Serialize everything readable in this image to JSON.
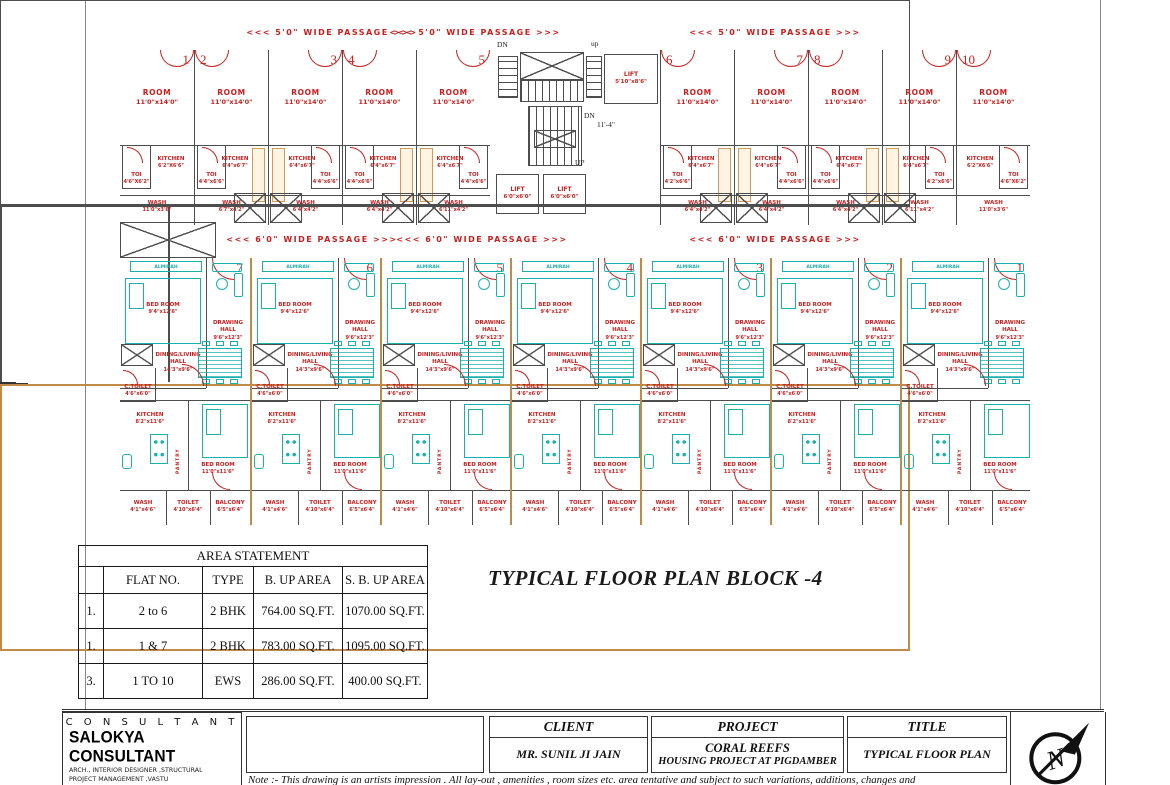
{
  "colors": {
    "red": "#c9201f",
    "teal": "#19b1ae",
    "wall": "#4d4d4d",
    "tan": "#d79a55",
    "tan_fill": "#fdf4e4",
    "black": "#1a1a1a"
  },
  "plan": {
    "passage_top_label": "<<< 5'0\" WIDE PASSAGE >>>",
    "passage_mid_label": "<<< 6'0\" WIDE PASSAGE >>>",
    "core": {
      "dn": "DN",
      "up_lower": "up",
      "up": "UP",
      "dim": "11'-4\"",
      "lift": "LIFT",
      "lift_top_dim": "5'10\"x8'6\"",
      "lift_dim": "6'0\"x6'0\""
    },
    "ews": {
      "room": "ROOM",
      "room_dim": "11'0\"x14'0\"",
      "kitchen": "KITCHEN",
      "kitchen_dim": "6'4\"x6'7\"",
      "kitchen_dim_end": "6'2\"X6'6\"",
      "toi": "TOI",
      "wash": "WASH",
      "units": [
        {
          "num": "1",
          "side": "R",
          "end": true,
          "toi_dim": "4'6\"X6'2\"",
          "wash_dim": "11'0\"x3'6\""
        },
        {
          "num": "2",
          "side": "L",
          "end": false,
          "toi_dim": "4'4\"x6'6\"",
          "wash_dim": "6'7\"x4'2\""
        },
        {
          "num": "3",
          "side": "R",
          "end": false,
          "toi_dim": "4'4\"x6'6\"",
          "wash_dim": "6'4\"x4'2\""
        },
        {
          "num": "4",
          "side": "L",
          "end": false,
          "toi_dim": "4'4\"x6'6\"",
          "wash_dim": "6'4\"x4'2\""
        },
        {
          "num": "5",
          "side": "R",
          "end": false,
          "toi_dim": "4'4\"x6'6\"",
          "wash_dim": "6'11\"x4'2\""
        },
        {
          "num": "6",
          "side": "L",
          "end": false,
          "toi_dim": "4'2\"x6'6\"",
          "wash_dim": "6'4\"x4'2\""
        },
        {
          "num": "7",
          "side": "R",
          "end": false,
          "toi_dim": "4'4\"x6'6\"",
          "wash_dim": "6'4\"x4'2\""
        },
        {
          "num": "8",
          "side": "L",
          "end": false,
          "toi_dim": "4'4\"x6'6\"",
          "wash_dim": "6'4\"x4'2\""
        },
        {
          "num": "9",
          "side": "R",
          "end": false,
          "toi_dim": "4'2\"x6'6\"",
          "wash_dim": "6'11\"x4'2\""
        },
        {
          "num": "10",
          "side": "L",
          "end": true,
          "toi_dim": "4'6\"X6'2\"",
          "wash_dim": "11'0\"x3'6\""
        }
      ]
    },
    "bhk": {
      "almirah": "ALMIRAH",
      "bed1": "BED ROOM",
      "bed1_dim": "9'4\"x12'6\"",
      "drawing": "DRAWING HALL",
      "drawing_dim": "9'6\"x12'3\"",
      "dining": "DINING/LIVING HALL",
      "dining_dim": "14'3\"x9'6\"",
      "ctoilet": "C.TOILET",
      "ctoilet_dim": "4'6\"x6'0\"",
      "kitchen": "KITCHEN",
      "kitchen_dim": "8'2\"x11'6\"",
      "pantry": "PANTRY",
      "bed2": "BED ROOM",
      "bed2_dim": "11'0\"x11'6\"",
      "wash": "WASH",
      "wash_dim": "4'1\"x4'6\"",
      "toilet": "TOILET",
      "toilet_dim": "4'10\"x6'4\"",
      "balcony": "BALCONY",
      "balcony_dim": "6'5\"x6'4\"",
      "numbers": [
        "7",
        "6",
        "5",
        "4",
        "3",
        "2",
        "1"
      ]
    }
  },
  "plan_title": "TYPICAL FLOOR PLAN  BLOCK -4",
  "area_table": {
    "title": "AREA STATEMENT",
    "headers": [
      "",
      "FLAT NO.",
      "TYPE",
      "B. UP AREA",
      "S. B. UP AREA"
    ],
    "rows": [
      [
        "1.",
        "2 to 6",
        "2 BHK",
        "764.00 SQ.FT.",
        "1070.00 SQ.FT."
      ],
      [
        "1.",
        "1 & 7",
        "2 BHK",
        "783.00 SQ.FT.",
        "1095.00 SQ.FT."
      ],
      [
        "3.",
        "1 TO 10",
        "EWS",
        "286.00 SQ.FT.",
        "400.00 SQ.FT."
      ]
    ]
  },
  "titleblock": {
    "consultant_header": "C O N S U L T A N T",
    "consultant_name": "SALOKYA CONSULTANT",
    "consultant_line1": "ARCH., INTERIOR DESIGNER ,STRUCTURAL",
    "consultant_line2": "PROJECT MANAGEMENT ,VASTU",
    "consultant_line3": "302 EXT MANAS BHAVAN RNT MARG",
    "consultant_line4": "INDORE [M.P.]",
    "client_header": "CLIENT",
    "client_name": "MR. SUNIL JI JAIN",
    "project_header": "PROJECT",
    "project_name": "CORAL REEFS",
    "project_sub": "HOUSING PROJECT AT PIGDAMBER",
    "title_header": "TITLE",
    "title_name": "TYPICAL FLOOR PLAN",
    "note": "Note :- This drawing is an artists impression . All lay-out , amenities , room sizes etc. area tentative and subject to such variations, additions, changes and",
    "north_letter": "N"
  }
}
